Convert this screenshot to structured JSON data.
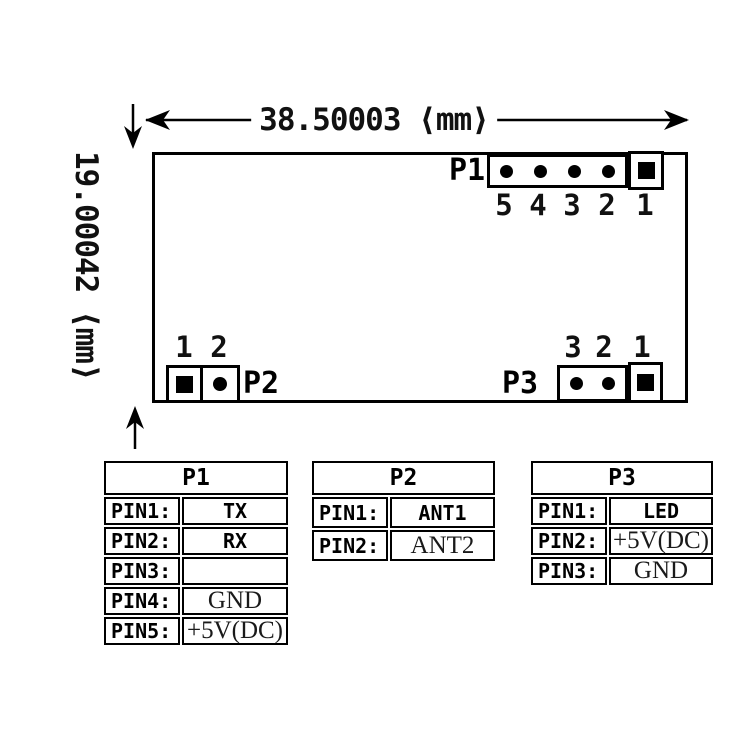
{
  "drawing": {
    "width_dim_label": "38.50003 ⟨mm⟩",
    "height_dim_label": "19.00042 ⟨mm⟩"
  },
  "board": {
    "p1": {
      "label": "P1",
      "pins": [
        "5",
        "4",
        "3",
        "2",
        "1"
      ]
    },
    "p2": {
      "label": "P2",
      "pins": [
        "1",
        "2"
      ]
    },
    "p3": {
      "label": "P3",
      "pins": [
        "3",
        "2",
        "1"
      ]
    }
  },
  "tables": [
    {
      "title": "P1",
      "rows": [
        {
          "label": "PIN1:",
          "value": "TX"
        },
        {
          "label": "PIN2:",
          "value": "RX"
        },
        {
          "label": "PIN3:",
          "value": ""
        },
        {
          "label": "PIN4:",
          "value": "GND"
        },
        {
          "label": "PIN5:",
          "value": "+5V(DC)"
        }
      ]
    },
    {
      "title": "P2",
      "rows": [
        {
          "label": "PIN1:",
          "value": "ANT1"
        },
        {
          "label": "PIN2:",
          "value": "ANT2"
        }
      ]
    },
    {
      "title": "P3",
      "rows": [
        {
          "label": "PIN1:",
          "value": "LED"
        },
        {
          "label": "PIN2:",
          "value": "+5V(DC)"
        },
        {
          "label": "PIN3:",
          "value": "GND"
        }
      ]
    }
  ]
}
